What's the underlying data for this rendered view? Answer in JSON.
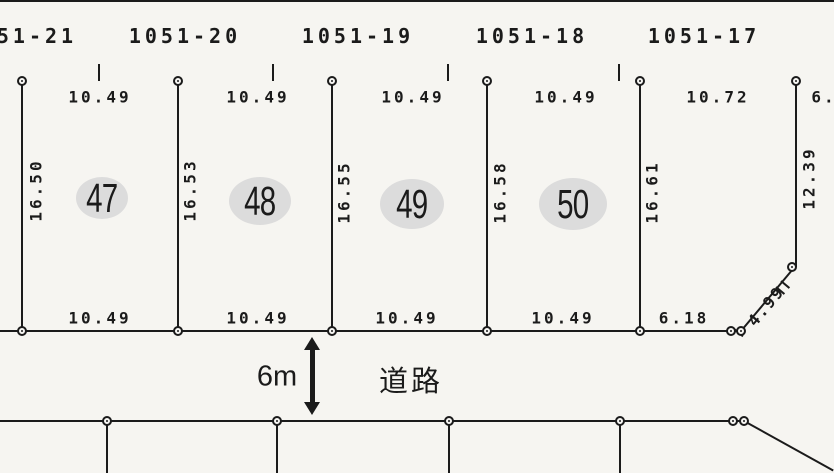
{
  "document": {
    "type": "cadastral-survey-map",
    "paper_color": "#f6f5f1",
    "ink_color": "#1b1b1b",
    "parcel_highlight_color": "#dcdcdc"
  },
  "upper_lots": [
    "51-21",
    "1051-20",
    "1051-19",
    "1051-18",
    "1051-17"
  ],
  "top_dimensions": [
    "10.49",
    "10.49",
    "10.49",
    "10.49",
    "10.72",
    "6."
  ],
  "side_dimensions": [
    "16.50",
    "16.53",
    "16.55",
    "16.58",
    "16.61",
    "12.39"
  ],
  "bottom_dimensions": [
    "10.49",
    "10.49",
    "10.49",
    "10.49",
    "6.18"
  ],
  "diagonal_dimension": "4.99",
  "parcels": [
    {
      "number": "47"
    },
    {
      "number": "48"
    },
    {
      "number": "49"
    },
    {
      "number": "50"
    }
  ],
  "road": {
    "name": "道路",
    "width_label": "6m"
  }
}
